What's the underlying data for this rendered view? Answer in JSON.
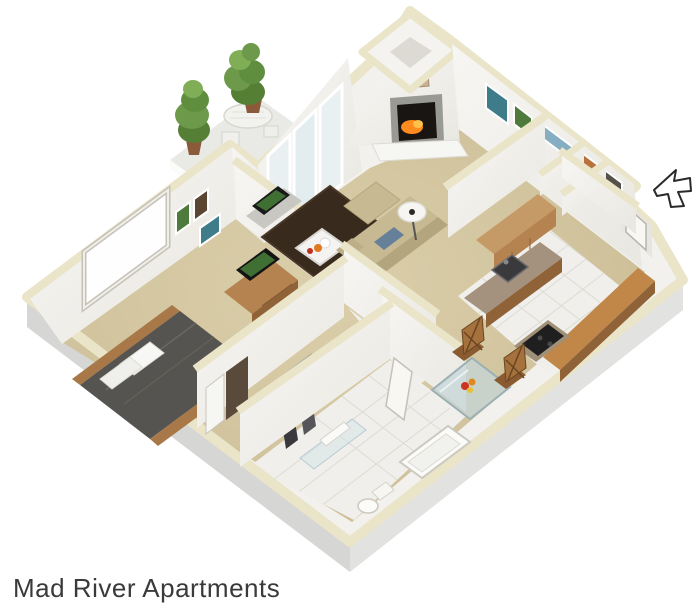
{
  "title": {
    "text": "Mad River Apartments"
  },
  "scene": {
    "label": "3D isometric one-bedroom apartment floor plan",
    "rooms": [
      "balcony",
      "living-room",
      "dining-area",
      "kitchen",
      "entry",
      "bedroom",
      "walk-in-closet",
      "bathroom"
    ],
    "furniture": [
      "potted-trees",
      "patio-table",
      "sliding-glass-door",
      "fireplace",
      "chimney",
      "tv-console",
      "sectional-sofa",
      "blue-pillow",
      "coffee-table",
      "floor-lamp",
      "area-rug",
      "dining-table",
      "dining-chairs",
      "flower-vase",
      "kitchen-upper-cabinets",
      "kitchen-counter",
      "kitchen-sink",
      "stove",
      "breakfast-bar",
      "pantry",
      "bed",
      "pillows",
      "dresser-with-tv",
      "bedroom-window",
      "wall-art",
      "hanging-clothes",
      "bathtub",
      "toilet",
      "shower-glass",
      "towel-bar",
      "entry-door",
      "entry-arrow"
    ]
  },
  "colors": {
    "text": "#3a3a3a",
    "cream": "#eae4c8",
    "wall": "#f4f2ee",
    "wallShade": "#e7e5df",
    "skirtLeft": "#d6d6d4",
    "skirtRight": "#e2e2e0",
    "carpet": "#d2c5a0",
    "tile": "#f0efeb",
    "wood": "#b5834f",
    "woodDark": "#8f6238",
    "counter": "#a5927e",
    "bed": "#565450",
    "sofa": "#c7ba92",
    "rug": "#392a1e",
    "tree": "#6d9a4a",
    "fire": "#ff8a1e",
    "glass": "#d6e4e8"
  }
}
